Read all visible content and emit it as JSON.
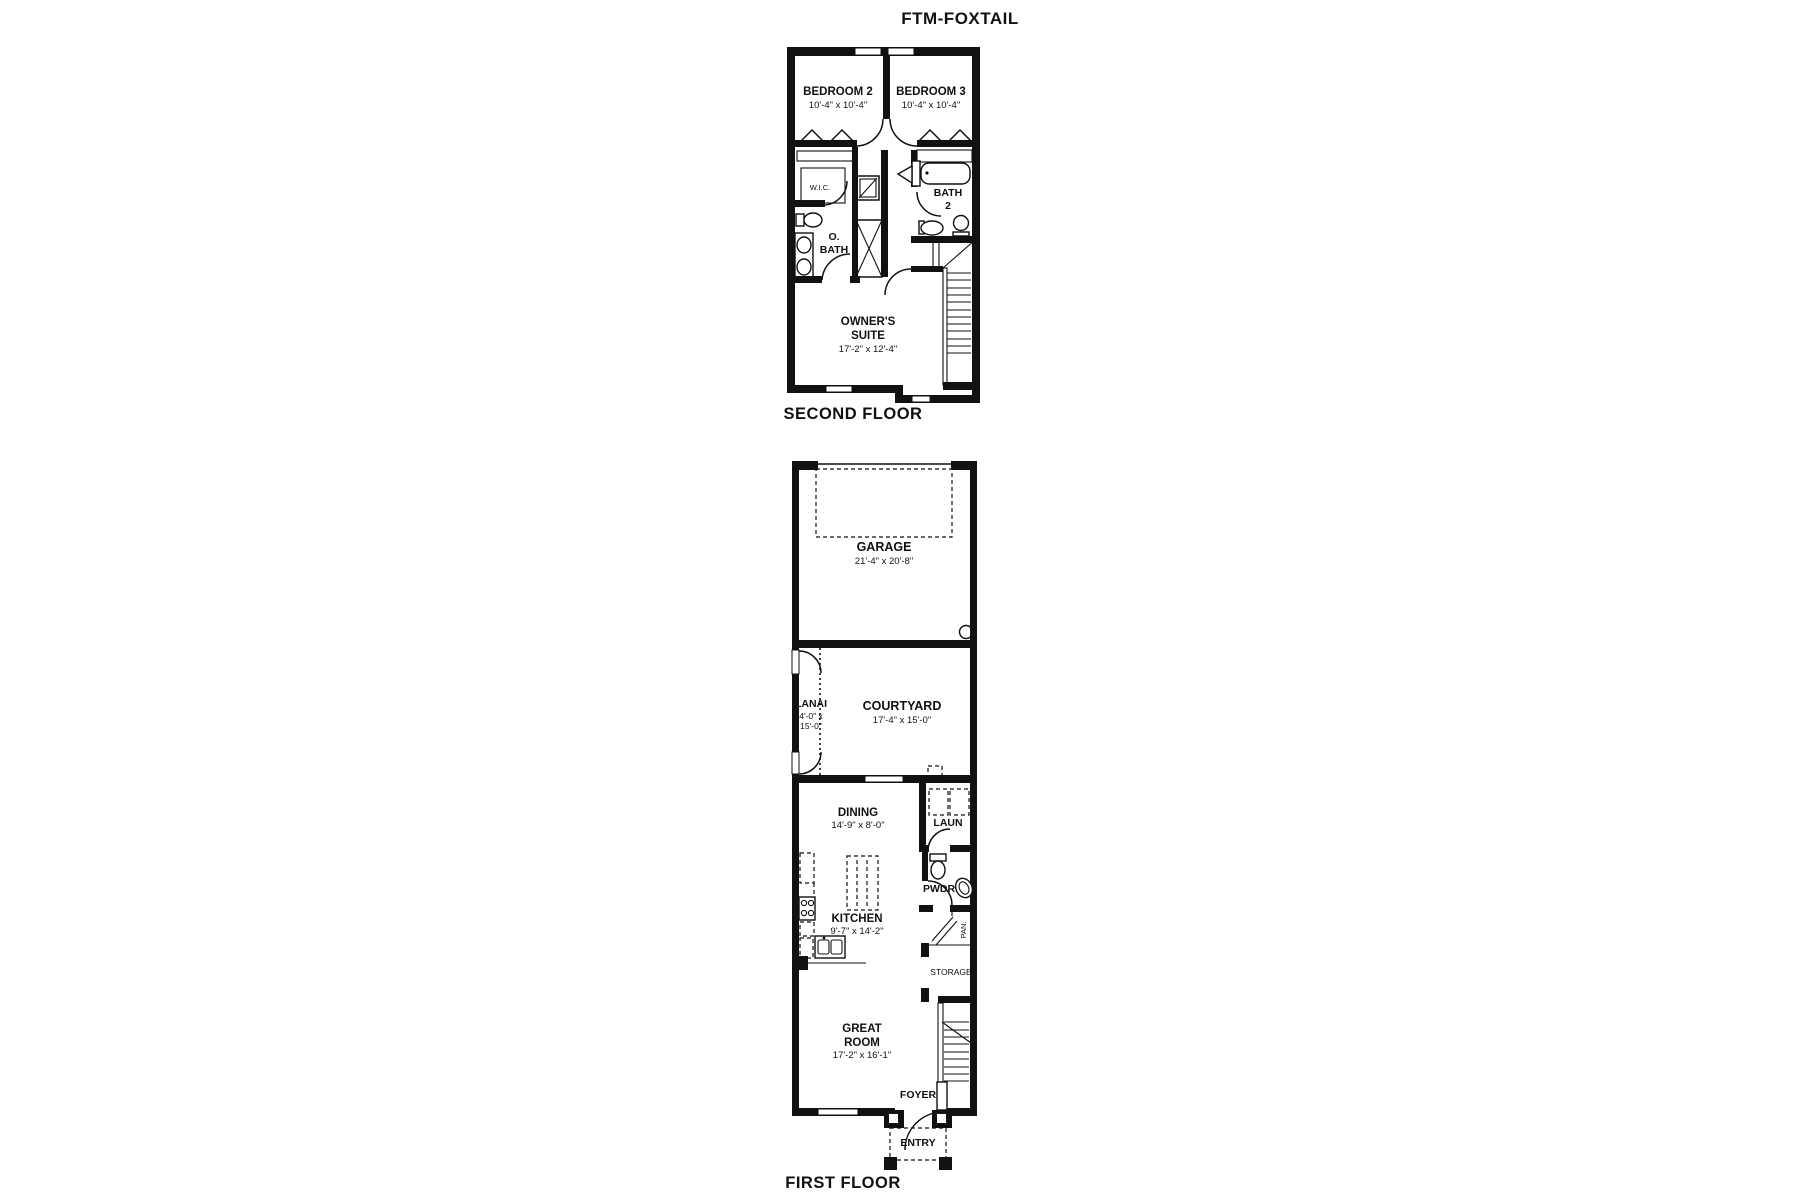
{
  "title": "FTM-FOXTAIL",
  "second_floor": {
    "label": "SECOND FLOOR",
    "rooms": {
      "bedroom2": {
        "name": "BEDROOM 2",
        "dims": "10'-4\" x 10'-4\""
      },
      "bedroom3": {
        "name": "BEDROOM 3",
        "dims": "10'-4\" x 10'-4\""
      },
      "wic": {
        "name": "W.I.C."
      },
      "o_bath": {
        "line1": "O.",
        "line2": "BATH"
      },
      "bath2": {
        "line1": "BATH",
        "line2": "2"
      },
      "owners_suite": {
        "line1": "OWNER'S",
        "line2": "SUITE",
        "dims": "17'-2\" x 12'-4\""
      }
    }
  },
  "first_floor": {
    "label": "FIRST FLOOR",
    "rooms": {
      "garage": {
        "name": "GARAGE",
        "dims": "21'-4\" x 20'-8\""
      },
      "lanai": {
        "name": "LANAI",
        "dims1": "4'-0\" x",
        "dims2": "15'-0\""
      },
      "courtyard": {
        "name": "COURTYARD",
        "dims": "17'-4\" x 15'-0\""
      },
      "dining": {
        "name": "DINING",
        "dims": "14'-9\" x 8'-0\""
      },
      "laundry": {
        "name": "LAUN"
      },
      "powder": {
        "name": "PWDR"
      },
      "kitchen": {
        "name": "KITCHEN",
        "dims": "9'-7\" x 14'-2\""
      },
      "pantry": {
        "name": "PAN."
      },
      "storage": {
        "name": "STORAGE"
      },
      "great_room": {
        "line1": "GREAT",
        "line2": "ROOM",
        "dims": "17'-2\" x 16'-1\""
      },
      "foyer": {
        "name": "FOYER"
      },
      "entry": {
        "name": "ENTRY"
      }
    }
  }
}
